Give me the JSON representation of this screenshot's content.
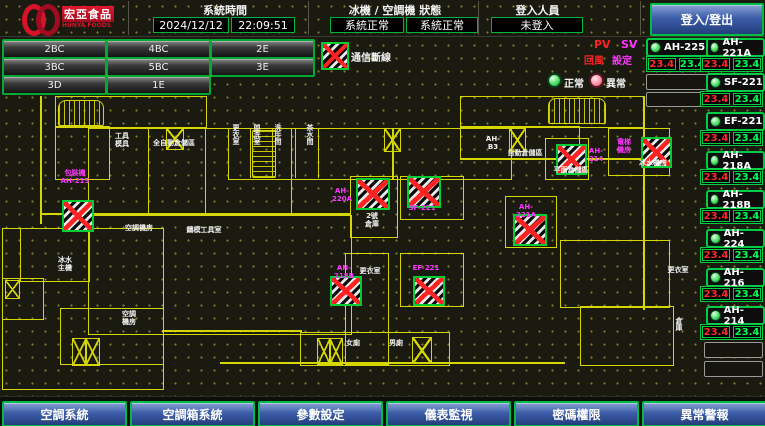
{
  "header": {
    "brand": {
      "name_zh": "宏亞食品",
      "name_en": "HUNYA FOODS"
    },
    "time_section": {
      "label": "系統時間",
      "date": "2024/12/12",
      "time": "22:09:51"
    },
    "status_section": {
      "label": "冰機 / 空調機 狀態",
      "chiller_status": "系統正常",
      "ahu_status": "系統正常"
    },
    "login_section": {
      "label": "登入人員",
      "user": "未登入"
    },
    "login_button": "登入/登出"
  },
  "floor_nav": {
    "buttons": [
      "2BC",
      "4BC",
      "2E",
      "3BC",
      "5BC",
      "3E",
      "3D",
      "1E"
    ]
  },
  "legend": {
    "comm_loss_label": "通信斷線",
    "pv_abbr": "PV",
    "sv_abbr": "SV",
    "pv_name": "回風",
    "sv_name": "設定",
    "normal_label": "正常",
    "abnormal_label": "異常"
  },
  "units": {
    "left_column": [
      {
        "name": "AH-225",
        "pv": "23.4",
        "sv": "23.4"
      }
    ],
    "right_column": [
      {
        "name": "AH-221A",
        "pv": "23.4",
        "sv": "23.4"
      },
      {
        "name": "SF-221",
        "pv": "23.4",
        "sv": "23.4"
      },
      {
        "name": "EF-221",
        "pv": "23.4",
        "sv": "23.4"
      },
      {
        "name": "AH-218A",
        "pv": "23.4",
        "sv": "23.4"
      },
      {
        "name": "AH-218B",
        "pv": "23.4",
        "sv": "23.4"
      },
      {
        "name": "AH-224",
        "pv": "23.4",
        "sv": "23.4"
      },
      {
        "name": "AH-216",
        "pv": "23.4",
        "sv": "23.4"
      },
      {
        "name": "AH-214",
        "pv": "23.4",
        "sv": "23.4"
      }
    ]
  },
  "map": {
    "room_labels": [
      "工具\n模具",
      "全自動倉儲區",
      "更衣室",
      "盥洗室",
      "洗手間",
      "茶水間",
      "AH-B3",
      "自動倉儲區",
      "平面倉儲區",
      "冰水機房",
      "空調機房",
      "鑄模工具室",
      "冰水\n主機",
      "空調\n機房",
      "2號\n倉庫",
      "更衣室",
      "女廁",
      "男廁",
      "更衣室",
      "倉庫"
    ],
    "ahu_labels": [
      "包裝機\nAH-215",
      "AH-220A",
      "SF-221",
      "AH-221A",
      "AH-214",
      "電梯\n機房",
      "AH-218B",
      "EF-221"
    ]
  },
  "bottom_nav": {
    "buttons": [
      "空調系統",
      "空調箱系統",
      "參數設定",
      "儀表監視",
      "密碼權限",
      "異常警報"
    ]
  },
  "colors": {
    "accent_green": "#00cc44",
    "alarm_red": "#ff2222",
    "label_magenta": "#ff35ff",
    "wall_yellow": "#d6d600",
    "button_blue": "#3c5da8"
  }
}
